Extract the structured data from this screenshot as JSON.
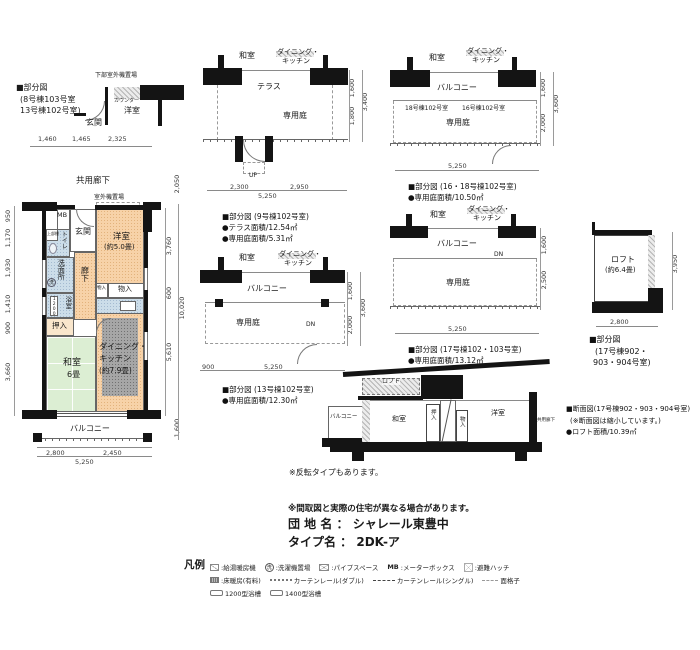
{
  "partial_8_13": {
    "caption": {
      "line1": "■部分図",
      "line2": "(8号棟103号室",
      "line3": "13号棟102号室)"
    },
    "labels": {
      "lower_outdoor_unit": "下部室外機置場",
      "counter": "カウンター",
      "western_room": "洋室",
      "entrance": "玄関"
    },
    "dims": {
      "width": [
        "1,460",
        "1,465",
        "2,325"
      ]
    }
  },
  "main_plan": {
    "labels": {
      "common_corridor": "共用廊下",
      "outdoor_unit": "室外機置場",
      "meter_box": "MB",
      "entrance": "玄関",
      "upper_shelf": "上部棚",
      "toilet": "トイレ",
      "washroom": "洗面所",
      "washer": "洗",
      "corridor": "廊下",
      "storage_small": "物入",
      "storage": "物入",
      "bathroom": "浴室",
      "bath_size": "1200",
      "closet": "押入",
      "japanese_room": "和室",
      "japanese_room_size": "6畳",
      "dk_line1": "ダイニング・",
      "dk_line2": "キッチン",
      "dk_line3": "(約7.9畳)",
      "western_room": "洋室",
      "western_room_size": "(約5.0畳)",
      "balcony": "バルコニー"
    },
    "dims": {
      "left": [
        "950",
        "1,170",
        "1,930",
        "1,410",
        "900",
        "3,660"
      ],
      "right": [
        "2,050",
        "3,760",
        "600",
        "5,610",
        "10,020",
        "1,600"
      ],
      "bottom": [
        "2,800",
        "2,450",
        "5,250"
      ]
    }
  },
  "partial_9": {
    "labels": {
      "japanese_room": "和室",
      "dk_line1": "ダイニング・",
      "dk_line2": "キッチン",
      "terrace": "テラス",
      "garden": "専用庭",
      "up": "UP"
    },
    "dims": {
      "right": [
        "1,600",
        "1,800",
        "3,400"
      ],
      "bottom": [
        "2,300",
        "2,950",
        "5,250"
      ]
    },
    "caption": {
      "line1": "■部分図 (9号棟102号室)",
      "line2": "●テラス面積/12.54㎡",
      "line3": "●専用庭面積/5.31㎡"
    }
  },
  "partial_13": {
    "labels": {
      "japanese_room": "和室",
      "dk_line1": "ダイニング・",
      "dk_line2": "キッチン",
      "balcony": "バルコニー",
      "garden": "専用庭",
      "dn": "DN"
    },
    "dims": {
      "right": [
        "1,600",
        "2,000",
        "3,600"
      ],
      "bottom": [
        "900",
        "5,250"
      ]
    },
    "caption": {
      "line1": "■部分図 (13号棟102号室)",
      "line2": "●専用庭面積/12.30㎡"
    }
  },
  "partial_16_18": {
    "labels": {
      "japanese_room": "和室",
      "dk_line1": "ダイニング・",
      "dk_line2": "キッチン",
      "balcony": "バルコニー",
      "unit_18": "18号棟102号室",
      "unit_16": "16号棟102号室",
      "garden": "専用庭"
    },
    "dims": {
      "right": [
        "1,600",
        "2,000",
        "3,600"
      ],
      "bottom": [
        "5,250"
      ]
    },
    "caption": {
      "line1": "■部分図 (16・18号棟102号室)",
      "line2": "●専用庭面積/10.50㎡"
    }
  },
  "partial_17": {
    "labels": {
      "japanese_room": "和室",
      "dk_line1": "ダイニング・",
      "dk_line2": "キッチン",
      "balcony": "バルコニー",
      "dn": "DN",
      "garden": "専用庭"
    },
    "dims": {
      "right": [
        "1,600",
        "2,500"
      ],
      "bottom": [
        "5,250"
      ]
    },
    "caption": {
      "line1": "■部分図 (17号棟102・103号室)",
      "line2": "●専用庭面積/13.12㎡"
    }
  },
  "partial_loft": {
    "labels": {
      "loft": "ロフト",
      "loft_size": "(約6.4畳)"
    },
    "dims": {
      "right": "3,950",
      "bottom": "2,800"
    },
    "caption": {
      "line1": "■部分図",
      "line2": "(17号棟902・",
      "line3": "903・904号室)"
    }
  },
  "section": {
    "labels": {
      "loft": "ロフト",
      "balcony": "バルコニー",
      "japanese_room": "和室",
      "closet": "押入",
      "storage": "物入",
      "western_room": "洋室",
      "common_corridor": "共用廊下"
    },
    "caption": {
      "line1": "■断面図(17号棟902・903・904号室)",
      "line2": "(※断面図は縮小しています。)",
      "line3": "●ロフト面積/10.39㎡"
    }
  },
  "notes": {
    "reverse": "※反転タイプもあります。",
    "disclaimer": "※間取図と実際の住宅が異なる場合があります。",
    "estate_label": "団 地 名 ：",
    "estate_name": "シャレール東豊中",
    "type_label": "タイプ名 ：",
    "type_name": "2DK-ア"
  },
  "legend": {
    "title": "凡例",
    "row1": [
      {
        "icon": "hot-water-heater",
        "label": ":給湯暖房機"
      },
      {
        "icon": "washer-place",
        "icon_text": "洗",
        "label": ":洗濯機置場"
      },
      {
        "icon": "pipe-space",
        "label": ":パイプスペース"
      },
      {
        "icon": "meter-box",
        "icon_text": "MB",
        "label": ":メーターボックス"
      },
      {
        "icon": "escape-hatch",
        "label": ":避難ハッチ"
      }
    ],
    "row2": [
      {
        "icon": "floor-heating",
        "label": ":床暖房(有料)"
      },
      {
        "icon": "curtain-rail-double",
        "label": "カーテンレール(ダブル)"
      },
      {
        "icon": "curtain-rail-single",
        "label": "カーテンレール(シングル)"
      },
      {
        "icon": "lattice",
        "label": "面格子"
      }
    ],
    "row3": [
      {
        "icon": "bathtub-1200",
        "label": "1200型浴槽"
      },
      {
        "icon": "bathtub-1400",
        "label": "1400型浴槽"
      }
    ]
  }
}
